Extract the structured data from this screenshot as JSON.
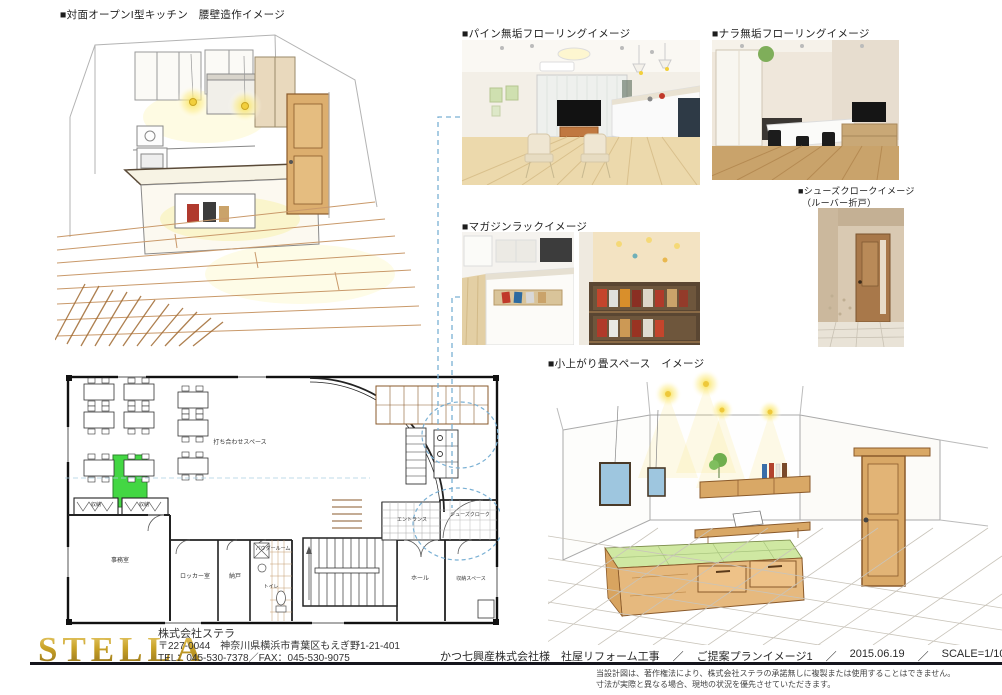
{
  "labels": {
    "kitchen": "■対面オープンI型キッチン　腰壁造作イメージ",
    "pine": "■パイン無垢フローリングイメージ",
    "oak": "■ナラ無垢フローリングイメージ",
    "shoes_line1": "■シューズクロークイメージ",
    "shoes_line2": "（ルーバー折戸）",
    "magazine": "■マガジンラックイメージ",
    "tatami": "■小上がり畳スペース　イメージ"
  },
  "floor_plan": {
    "rooms": [
      "打ち合わせスペース",
      "事務室",
      "ロッカー室",
      "納戸",
      "パウダールーム",
      "トイレ",
      "収納",
      "収納",
      "エントランス",
      "シューズクローク",
      "ホール",
      "収納スペース"
    ]
  },
  "footer": {
    "logo": "STELLA",
    "company": "株式会社ステラ",
    "address": "〒227-0044　神奈川県横浜市青葉区もえぎ野1-21-401",
    "tel_fax": "TEL：045-530-7378／FAX：045-530-9075",
    "project": "かつ七興産株式会社様　社屋リフォーム工事",
    "separator": "／",
    "plan_name": "ご提案プランイメージ1",
    "date": "2015.06.19",
    "scale": "SCALE=1/100",
    "number": "No.",
    "disclaimer1": "当設計図は、著作権法により、株式会社ステラの承諾無しに複製または使用することはできません。",
    "disclaimer2": "寸法が実際と異なる場合、現地の状況を優先させていただきます。"
  },
  "colors": {
    "accent_green": "#2fd32f",
    "dashed_blue": "#7ab0d4",
    "gold": "#c9a227",
    "wood_tan": "#d9a866",
    "tatami_green": "#cfe8a2",
    "line_black": "#15151d"
  }
}
